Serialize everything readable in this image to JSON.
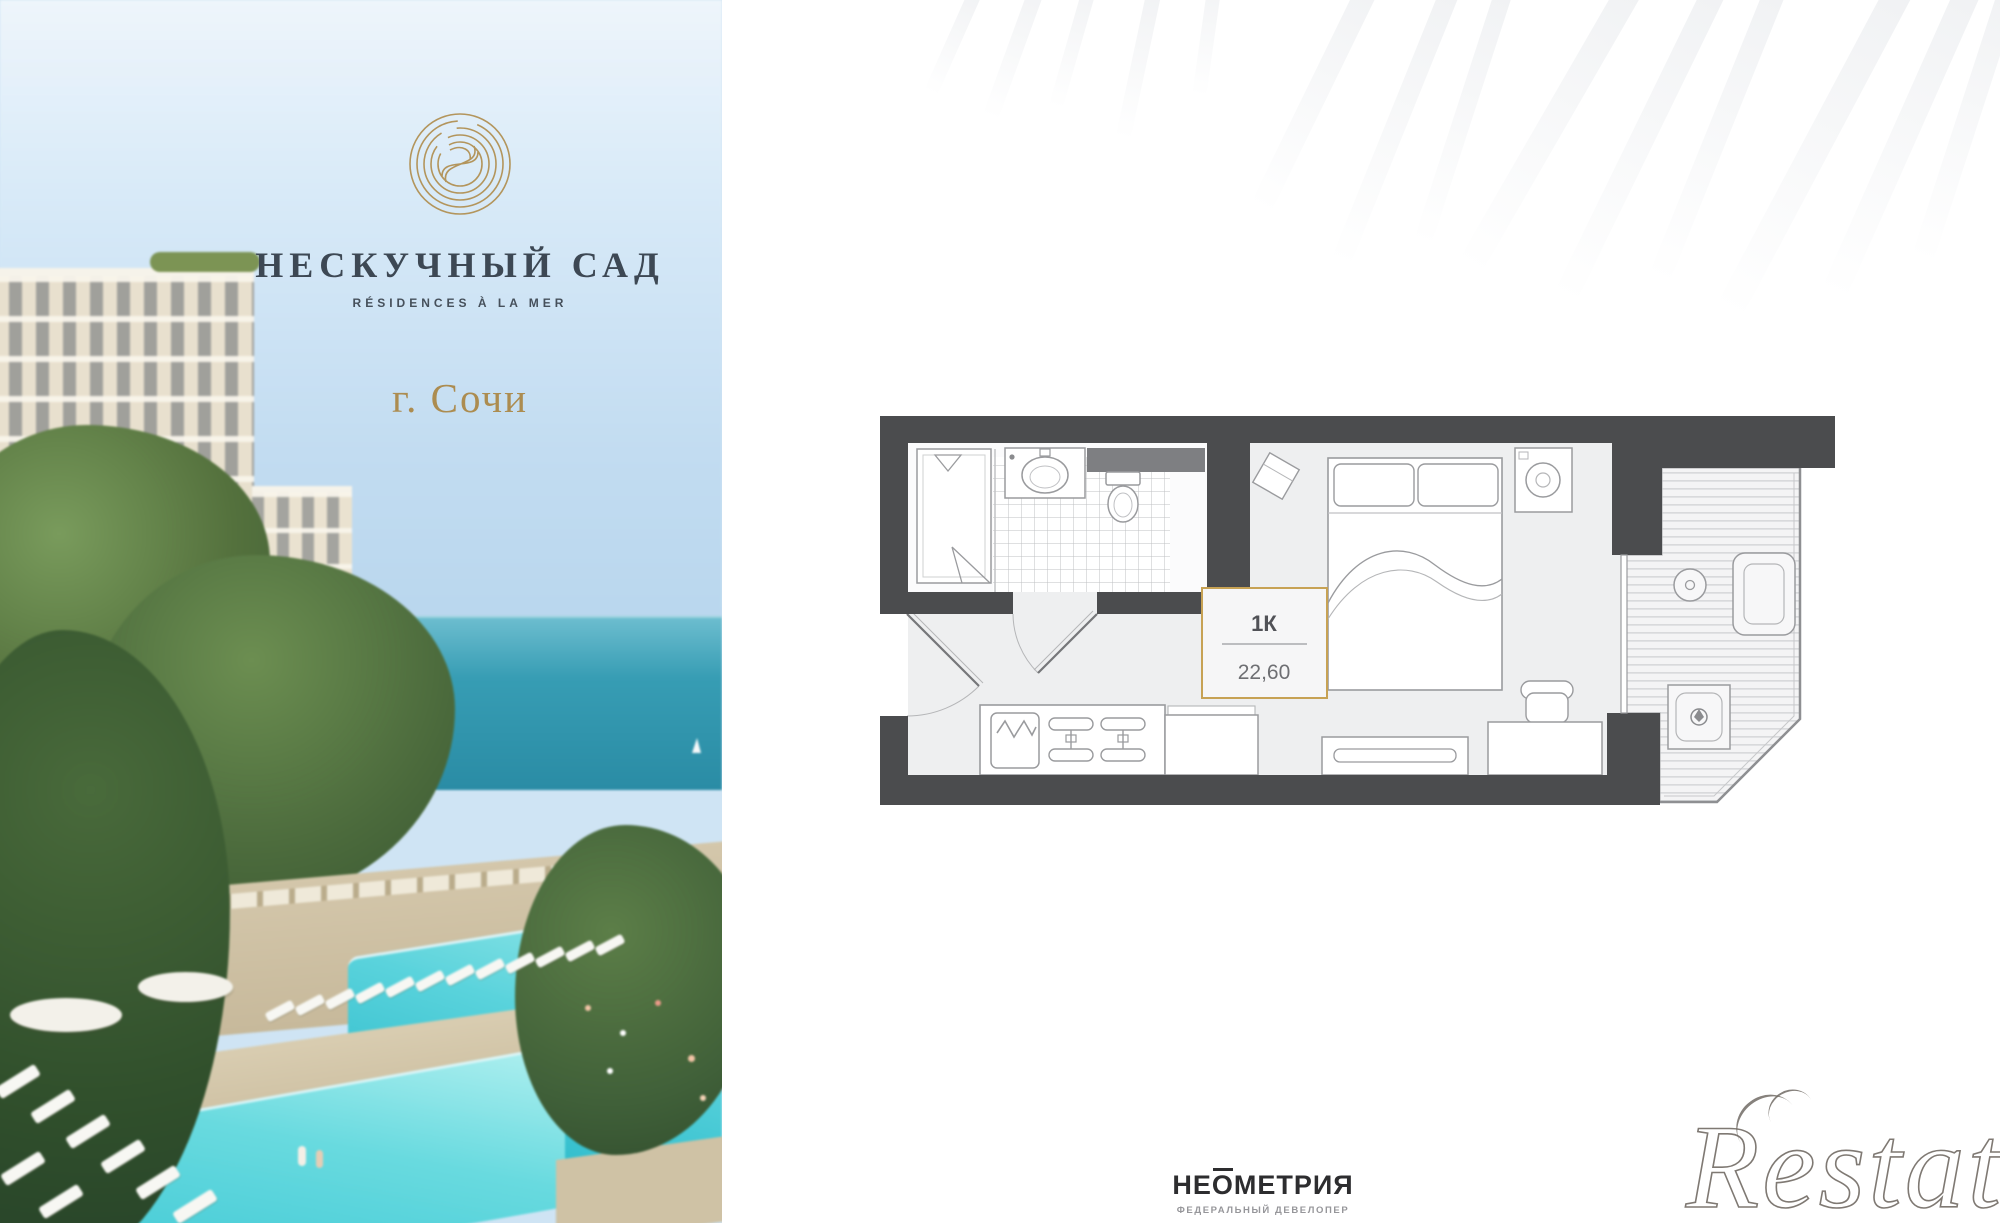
{
  "hero": {
    "brand_name": "НЕСКУЧНЫЙ САД",
    "brand_subtitle": "RÉSIDENCES À LA MER",
    "city": "г. Сочи",
    "colors": {
      "gold": "#b3955c",
      "brand_text": "#3d4854",
      "sky": "#cfe4f4",
      "sea": "#3b9cb2",
      "pool": "#5fd2da"
    }
  },
  "plan": {
    "unit_type": "1К",
    "area_m2": "22,60",
    "accent_gold": "#c7a254",
    "wall_color": "#4b4c4e",
    "floor_color": "#eeeff0"
  },
  "developer": {
    "name": "НЕОМЕТРИЯ",
    "tagline": "ФЕДЕРАЛЬНЫЙ ДЕВЕЛОПЕР"
  },
  "watermark": {
    "text": "Restate"
  }
}
